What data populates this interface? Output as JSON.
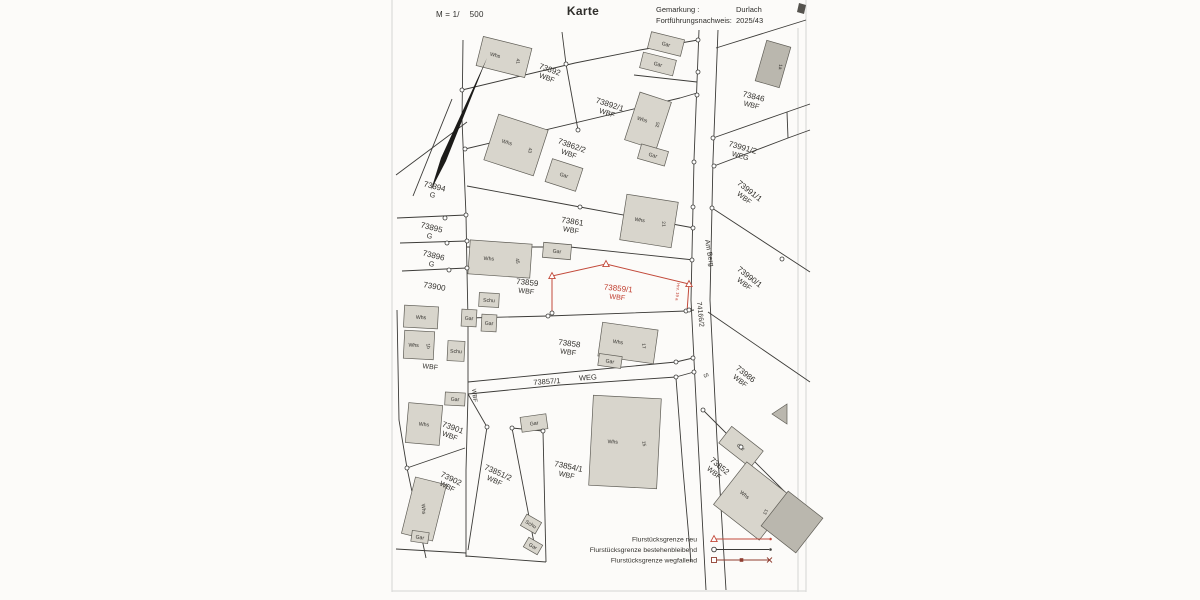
{
  "header": {
    "scale_label": "M = 1/",
    "scale_value": "500",
    "title": "Karte",
    "fields": [
      {
        "label": "Gemarkung :",
        "value": "Durlach"
      },
      {
        "label": "Fortführungsnachweis:",
        "value": "2025/43"
      }
    ]
  },
  "colors": {
    "paper": "#fcfbf9",
    "line": "#3c3b38",
    "text": "#33312d",
    "building_fill": "#d8d5cc",
    "building_fill_dark": "#bab7ae",
    "building_stroke": "#5f5d56",
    "red": "#c2493a",
    "red_text": "#c03d2e",
    "legend_removed": "#8f3d30",
    "scan_edge": "#dcdcda"
  },
  "map": {
    "street": {
      "name": "Am Berg",
      "parcel_number": "74166/2",
      "marker": "S"
    },
    "highlight_parcel": "73859/1",
    "house_number_note": "Hnr. 19 a",
    "parcel_labels": [
      {
        "id": "73892",
        "usage": "WBF",
        "x": 549,
        "y": 72,
        "rot": 20
      },
      {
        "id": "73892/1",
        "usage": "WBF",
        "x": 609,
        "y": 107,
        "rot": 18
      },
      {
        "id": "73846",
        "usage": "WBF",
        "x": 753,
        "y": 99,
        "rot": 14
      },
      {
        "id": "73862/2",
        "usage": "WBF",
        "x": 571,
        "y": 148,
        "rot": 20
      },
      {
        "id": "73991/2",
        "usage": "WEG",
        "x": 742,
        "y": 150,
        "rot": 16
      },
      {
        "id": "73991/1",
        "usage": "WBF",
        "x": 748,
        "y": 193,
        "rot": 38
      },
      {
        "id": "73990/1",
        "usage": "WBF",
        "x": 748,
        "y": 279,
        "rot": 38
      },
      {
        "id": "73894",
        "usage": "G",
        "x": 434,
        "y": 189,
        "rot": 14
      },
      {
        "id": "73895",
        "usage": "G",
        "x": 431,
        "y": 230,
        "rot": 14
      },
      {
        "id": "73896",
        "usage": "G",
        "x": 433,
        "y": 258,
        "rot": 14
      },
      {
        "id": "73900",
        "usage": "",
        "x": 434,
        "y": 289,
        "rot": 10
      },
      {
        "id": "73861",
        "usage": "WBF",
        "x": 572,
        "y": 224,
        "rot": 10
      },
      {
        "id": "73859",
        "usage": "WBF",
        "x": 527,
        "y": 285,
        "rot": 6
      },
      {
        "id": "73859/1",
        "usage": "WBF",
        "x": 618,
        "y": 291,
        "rot": 6,
        "red": true
      },
      {
        "id": "73858",
        "usage": "WBF",
        "x": 569,
        "y": 346,
        "rot": 8
      },
      {
        "id": "73986",
        "usage": "WBF",
        "x": 744,
        "y": 376,
        "rot": 38
      },
      {
        "id": "73901",
        "usage": "WBF",
        "x": 452,
        "y": 430,
        "rot": 20
      },
      {
        "id": "73902",
        "usage": "WBF",
        "x": 450,
        "y": 481,
        "rot": 26
      },
      {
        "id": "73851/2",
        "usage": "WBF",
        "x": 497,
        "y": 475,
        "rot": 24
      },
      {
        "id": "73854/1",
        "usage": "WBF",
        "x": 568,
        "y": 469,
        "rot": 12
      },
      {
        "id": "73852",
        "usage": "WBF",
        "x": 718,
        "y": 468,
        "rot": 40
      }
    ],
    "annotations": [
      {
        "text": "73857/1",
        "x": 547,
        "y": 384,
        "rot": -4,
        "size": 7.5
      },
      {
        "text": "WEG",
        "x": 588,
        "y": 380,
        "rot": -4,
        "size": 7.5
      },
      {
        "text": "WBF",
        "x": 430,
        "y": 369,
        "rot": 6,
        "size": 7
      },
      {
        "text": "WBF",
        "x": 472,
        "y": 389,
        "rot": 84,
        "size": 6,
        "anchor": "start"
      },
      {
        "text": "Am Berg",
        "x": 705,
        "y": 240,
        "rot": 80,
        "size": 7,
        "anchor": "start"
      },
      {
        "text": "74166/2",
        "x": 697,
        "y": 302,
        "rot": 84,
        "size": 7,
        "anchor": "start"
      },
      {
        "text": "S",
        "x": 704,
        "y": 376,
        "rot": 70,
        "size": 6.5
      },
      {
        "text": "Hnr. 19 a",
        "x": 677,
        "y": 283,
        "rot": 95,
        "size": 4.3,
        "anchor": "start",
        "red": true
      }
    ],
    "buildings": [
      {
        "type": "Whs",
        "num": "41",
        "cx": 504,
        "cy": 57,
        "w": 50,
        "h": 30,
        "rot": 14
      },
      {
        "type": "Gar",
        "num": "",
        "cx": 666,
        "cy": 44,
        "w": 34,
        "h": 17,
        "rot": 14
      },
      {
        "type": "Gar",
        "num": "",
        "cx": 658,
        "cy": 64,
        "w": 34,
        "h": 16,
        "rot": 14
      },
      {
        "type": "",
        "num": "1a",
        "cx": 773,
        "cy": 64,
        "w": 25,
        "h": 42,
        "rot": 16,
        "dark": true
      },
      {
        "type": "Whs",
        "num": "43",
        "cx": 516,
        "cy": 145,
        "w": 52,
        "h": 48,
        "rot": 18
      },
      {
        "type": "Gar",
        "num": "",
        "cx": 564,
        "cy": 175,
        "w": 32,
        "h": 24,
        "rot": 18
      },
      {
        "type": "Whs",
        "num": "52",
        "cx": 648,
        "cy": 121,
        "w": 33,
        "h": 50,
        "rot": 18
      },
      {
        "type": "Gar",
        "num": "",
        "cx": 653,
        "cy": 155,
        "w": 28,
        "h": 15,
        "rot": 16
      },
      {
        "type": "Whs",
        "num": "21",
        "cx": 649,
        "cy": 221,
        "w": 52,
        "h": 46,
        "rot": 9
      },
      {
        "type": "Gar",
        "num": "",
        "cx": 557,
        "cy": 251,
        "w": 28,
        "h": 15,
        "rot": 5
      },
      {
        "type": "Whs",
        "num": "45",
        "cx": 500,
        "cy": 259,
        "w": 62,
        "h": 34,
        "rot": 4
      },
      {
        "type": "Schu",
        "num": "",
        "cx": 489,
        "cy": 300,
        "w": 20,
        "h": 14,
        "rot": 3
      },
      {
        "type": "Whs",
        "num": "",
        "cx": 421,
        "cy": 317,
        "w": 34,
        "h": 22,
        "rot": 3
      },
      {
        "type": "Whs",
        "num": "1b",
        "cx": 419,
        "cy": 345,
        "w": 30,
        "h": 28,
        "rot": 3
      },
      {
        "type": "Schu",
        "num": "",
        "cx": 456,
        "cy": 351,
        "w": 17,
        "h": 20,
        "rot": 3
      },
      {
        "type": "Gar",
        "num": "",
        "cx": 469,
        "cy": 318,
        "w": 15,
        "h": 17,
        "rot": 3
      },
      {
        "type": "Gar",
        "num": "",
        "cx": 489,
        "cy": 323,
        "w": 15,
        "h": 17,
        "rot": 3
      },
      {
        "type": "Gar",
        "num": "",
        "cx": 455,
        "cy": 399,
        "w": 20,
        "h": 13,
        "rot": 3
      },
      {
        "type": "Whs",
        "num": "",
        "cx": 424,
        "cy": 424,
        "w": 34,
        "h": 40,
        "rot": 5
      },
      {
        "type": "Whs",
        "num": "",
        "cx": 424,
        "cy": 509,
        "w": 32,
        "h": 58,
        "rot": 14,
        "label_rot": 70
      },
      {
        "type": "Gar",
        "num": "",
        "cx": 420,
        "cy": 537,
        "w": 17,
        "h": 11,
        "rot": 8
      },
      {
        "type": "Schu",
        "num": "",
        "cx": 531,
        "cy": 524,
        "w": 17,
        "h": 13,
        "rot": 30
      },
      {
        "type": "Gar",
        "num": "",
        "cx": 533,
        "cy": 546,
        "w": 16,
        "h": 11,
        "rot": 30
      },
      {
        "type": "Whs",
        "num": "17",
        "cx": 628,
        "cy": 343,
        "w": 56,
        "h": 34,
        "rot": 8
      },
      {
        "type": "Gar",
        "num": "",
        "cx": 610,
        "cy": 361,
        "w": 23,
        "h": 12,
        "rot": 8
      },
      {
        "type": "Whs",
        "num": "15",
        "cx": 625,
        "cy": 442,
        "w": 68,
        "h": 90,
        "rot": 3
      },
      {
        "type": "Gar",
        "num": "",
        "cx": 534,
        "cy": 423,
        "w": 26,
        "h": 15,
        "rot": -8
      },
      {
        "type": "Gar",
        "num": "",
        "cx": 741,
        "cy": 447,
        "w": 40,
        "h": 21,
        "rot": 38
      },
      {
        "type": "Whs",
        "num": "13",
        "cx": 753,
        "cy": 501,
        "w": 58,
        "h": 54,
        "rot": 38
      },
      {
        "type": "",
        "num": "",
        "cx": 792,
        "cy": 522,
        "w": 44,
        "h": 44,
        "rot": 38,
        "dark": true
      }
    ]
  },
  "legend": {
    "items": [
      {
        "label": "Flurstücksgrenze neu",
        "type": "new"
      },
      {
        "label": "Flurstücksgrenze bestehenbleibend",
        "type": "existing"
      },
      {
        "label": "Flurstücksgrenze wegfallend",
        "type": "removed"
      }
    ]
  }
}
